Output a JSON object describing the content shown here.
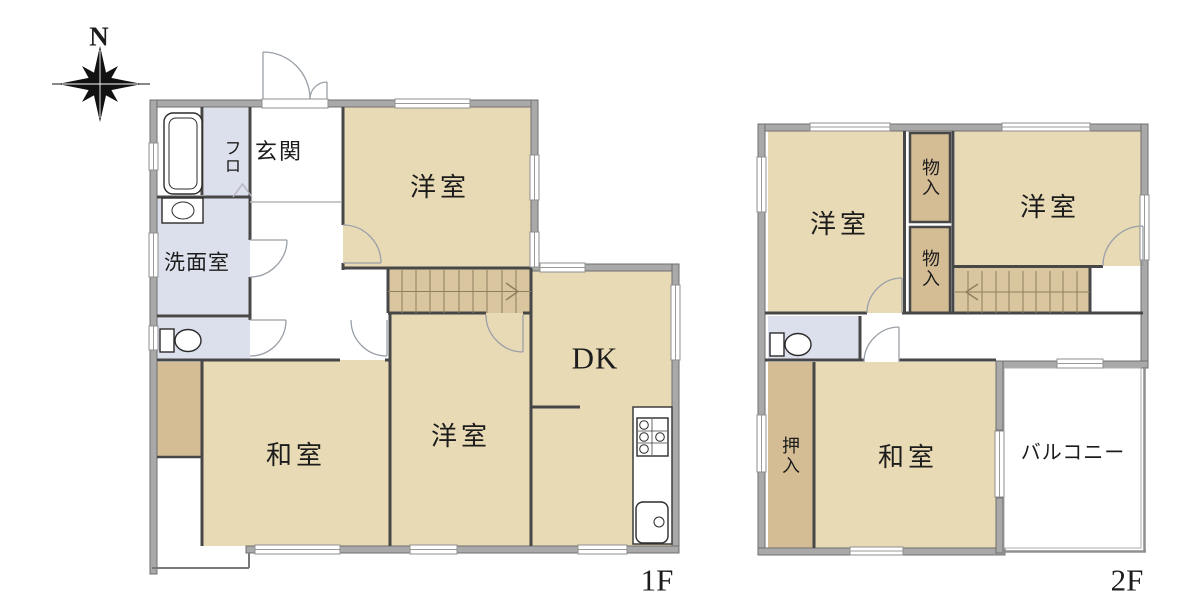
{
  "palette": {
    "room": "#e8dab5",
    "closet": "#d4bd95",
    "stairs": "#dac69e",
    "wet": "#dce0ec",
    "wall": "#a9a9a9",
    "walledge": "#6f6f6f",
    "line": "#474747",
    "ink": "#1c1c1c"
  },
  "compass": {
    "label": "N"
  },
  "icons": {
    "compass": "compass-rose",
    "bathtub": "bathtub-icon",
    "washbasin": "washbasin-icon",
    "toilet": "toilet-icon",
    "stove": "stove-icon",
    "kitchen_sink": "kitchen-sink-icon",
    "stairs_arrow_1f": "stairs-arrow-right",
    "stairs_arrow_2f": "stairs-arrow-left",
    "door": "door-swing-arc"
  },
  "floor1": {
    "label": "1F",
    "rooms": {
      "bath": "フロ",
      "entrance": "玄関",
      "washroom": "洗面室",
      "western_room_upper": "洋室",
      "dk": "DK",
      "western_room_lower": "洋室",
      "japanese_room": "和室"
    }
  },
  "floor2": {
    "label": "2F",
    "rooms": {
      "western_room_left": "洋室",
      "storage_upper": "物入",
      "storage_lower": "物入",
      "western_room_right": "洋室",
      "closet": "押入",
      "japanese_room": "和室",
      "balcony": "バルコニー"
    }
  }
}
